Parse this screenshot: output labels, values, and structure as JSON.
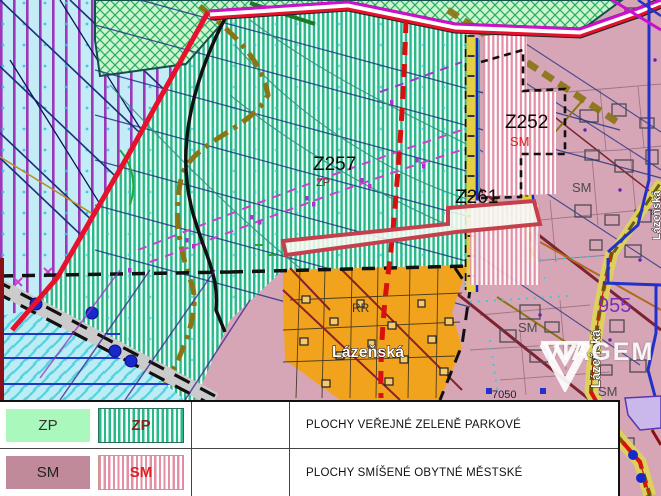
{
  "map": {
    "labels": {
      "z257": "Z257",
      "z257_type": "ZP",
      "z252": "Z252",
      "z252_type": "SM",
      "z261": "Z261",
      "rr": "RR",
      "sm_a": "SM",
      "sm_b": "SM",
      "sm_c": "SM",
      "street_h": "Lázeňská",
      "street_v": "Lázeňská",
      "street_edge": "Lázeňská",
      "num_955": "955",
      "num_7050": "7050"
    },
    "colors": {
      "zp_solid": "#aaf8bc",
      "zp_stripe": "#27b88b",
      "sm_solid": "#c18a9b",
      "sm_stripe": "#e390a6",
      "pink_zone": "#d6a6b6",
      "orange_zone": "#f2a31d",
      "water": "#bcecf4",
      "blue_stripe_area": "#c3ecf6",
      "highlight_outline": "#c4404c",
      "boundary_red": "#e8112d",
      "dashed_red": "#d81010",
      "road_magenta": "#cc11cc",
      "olive_line": "#8a7414"
    }
  },
  "legend": {
    "rows": [
      {
        "code": "ZP",
        "striped_code": "ZP",
        "description": "PLOCHY VEŘEJNÉ ZELENĚ PARKOVÉ"
      },
      {
        "code": "SM",
        "striped_code": "SM",
        "description": "PLOCHY SMÍŠENÉ OBYTNÉ MĚSTSKÉ"
      }
    ]
  },
  "watermark": {
    "text": "VIAGEM"
  }
}
